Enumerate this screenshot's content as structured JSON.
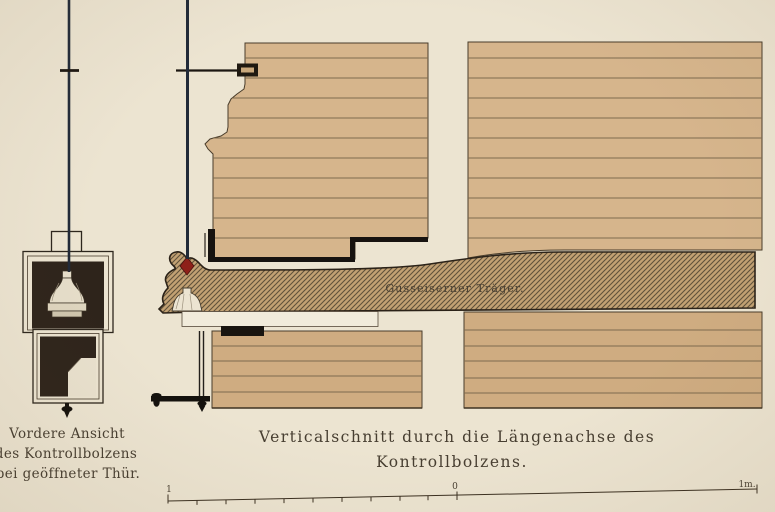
{
  "colors": {
    "paper": "#ece4d1",
    "masonry": "#d6b58c",
    "masonry_lower": "#cfac81",
    "beam_fill": "#c2a173",
    "beam_hatch": "#60513a",
    "chamber_dark": "#2e241b",
    "outline_dark": "#211b14",
    "wire": "#212a38",
    "red_marker": "#8e2019",
    "text": "#473e31"
  },
  "left_figure": {
    "caption_line1": "Vordere Ansicht",
    "caption_line2": "des Kontrollbolzens",
    "caption_line3": "bei geöffneter Thür."
  },
  "main_figure": {
    "beam_label": "Gusseiserner Träger.",
    "caption_line1": "Verticalschnitt durch die Längenachse des",
    "caption_line2": "Kontrollbolzens."
  },
  "scale_bar": {
    "left_label": "1",
    "center_label": "0",
    "right_label": "1m."
  }
}
